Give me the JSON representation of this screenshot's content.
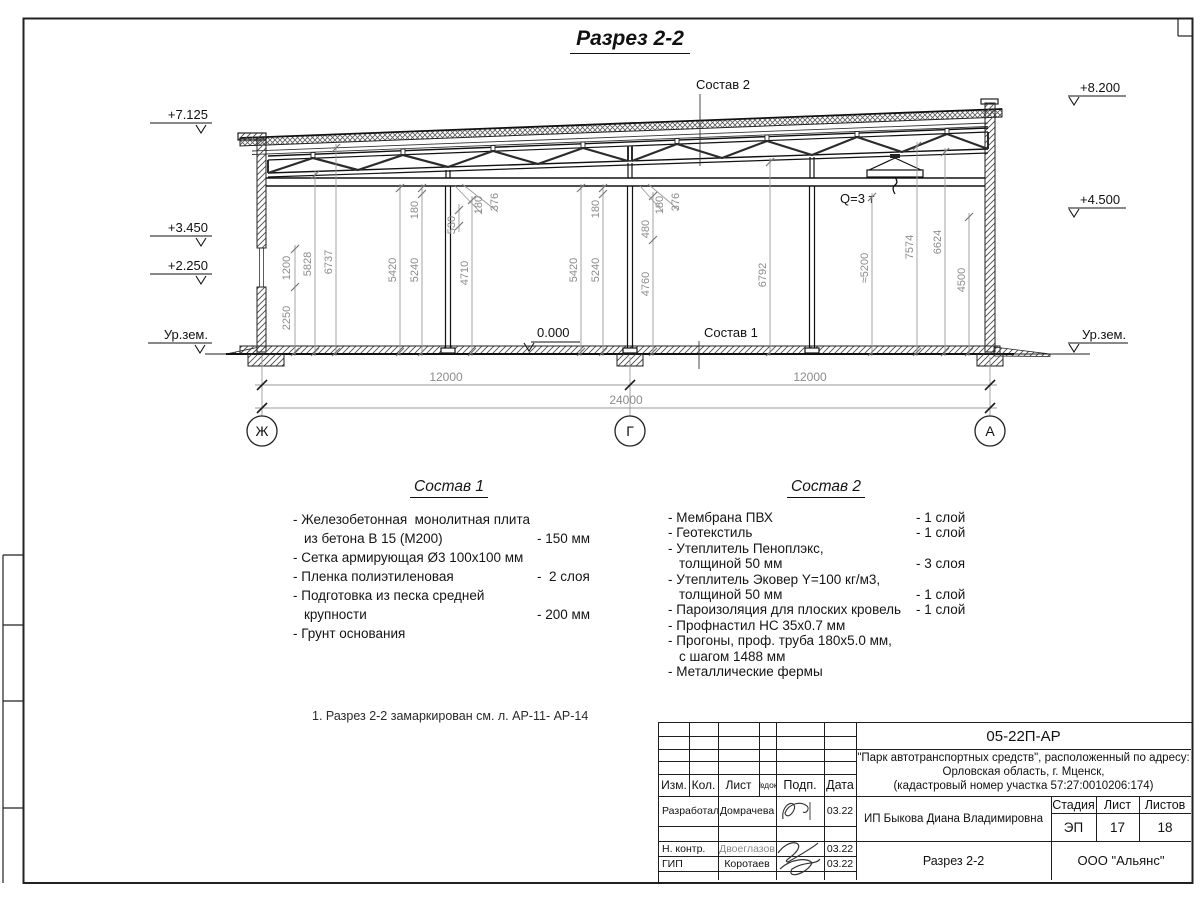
{
  "sheet": {
    "title": "Разрез 2-2",
    "note": "1. Разрез 2-2 замаркирован см. л. АР-11- АР-14"
  },
  "drawing": {
    "leader_top": "Состав 2",
    "leader_floor": "Состав 1",
    "crane": "Q=3 т",
    "zero": "0.000",
    "elev_left": [
      "+7.125",
      "+3.450",
      "+2.250",
      "Ур.зем."
    ],
    "elev_right": [
      "+8.200",
      "+4.500",
      "Ур.зем."
    ],
    "axes": [
      "Ж",
      "Г",
      "А"
    ],
    "dims_h": [
      "12000",
      "12000",
      "24000"
    ],
    "dims_v": [
      "1200",
      "2250",
      "5828",
      "6737",
      "5420",
      "180",
      "5240",
      "530",
      "180",
      "376",
      "4710",
      "5420",
      "180",
      "5240",
      "480",
      "180",
      "376",
      "4760",
      "6792",
      "≈5200",
      "7574",
      "6624",
      "4500"
    ]
  },
  "sostav1": {
    "title": "Состав 1",
    "rows": [
      {
        "t": "- Железобетонная  монолитная плита",
        "v": ""
      },
      {
        "t": "из бетона В 15 (М200)",
        "v": "- 150 мм"
      },
      {
        "t": "- Сетка армирующая Ø3 100х100 мм",
        "v": ""
      },
      {
        "t": "- Пленка полиэтиленовая",
        "v": "-  2 слоя"
      },
      {
        "t": "- Подготовка из песка средней",
        "v": ""
      },
      {
        "t": "крупности",
        "v": "- 200 мм"
      },
      {
        "t": "- Грунт основания",
        "v": ""
      }
    ]
  },
  "sostav2": {
    "title": "Состав 2",
    "rows": [
      {
        "t": "- Мембрана ПВХ",
        "v": "- 1 слой"
      },
      {
        "t": "- Геотекстиль",
        "v": "- 1 слой"
      },
      {
        "t": "- Утеплитель Пеноплэкс,",
        "v": ""
      },
      {
        "t": "толщиной 50 мм",
        "v": "- 3 слоя"
      },
      {
        "t": "- Утеплитель Эковер Y=100 кг/м3,",
        "v": ""
      },
      {
        "t": "толщиной 50 мм",
        "v": "- 1 слой"
      },
      {
        "t": "- Пароизоляция для плоских кровель",
        "v": "- 1 слой"
      },
      {
        "t": "- Профнастил НС 35х0.7 мм",
        "v": ""
      },
      {
        "t": "- Прогоны, проф. труба 180х5.0 мм,",
        "v": ""
      },
      {
        "t": "с шагом 1488 мм",
        "v": ""
      },
      {
        "t": "- Металлические фермы",
        "v": ""
      }
    ]
  },
  "titleblock": {
    "code": "05-22П-АР",
    "project_line1": "\"Парк автотранспортных средств\",  расположенный по адресу:",
    "project_line2": "Орловская область, г. Мценск,",
    "project_line3": "(кадастровый номер участка 57:27:0010206:174)",
    "cols": {
      "izm": "Изм.",
      "kol": "Кол.",
      "list": "Лист",
      "ndok": "№док.",
      "podp": "Подп.",
      "data": "Дата"
    },
    "rows": [
      {
        "role": "Разработал",
        "name": "Домрачева",
        "date": "03.22"
      },
      {
        "role": "Н. контр.",
        "name": "Двоеглазов",
        "date": "03.22"
      },
      {
        "role": "ГИП",
        "name": "Коротаев",
        "date": "03.22"
      }
    ],
    "client": "ИП Быкова Диана Владимировна",
    "stage_label": "Стадия",
    "sheet_label": "Лист",
    "sheets_label": "Листов",
    "stage": "ЭП",
    "sheet_num": "17",
    "sheets_total": "18",
    "drawing_name": "Разрез 2-2",
    "company": "ООО \"Альянс\""
  }
}
